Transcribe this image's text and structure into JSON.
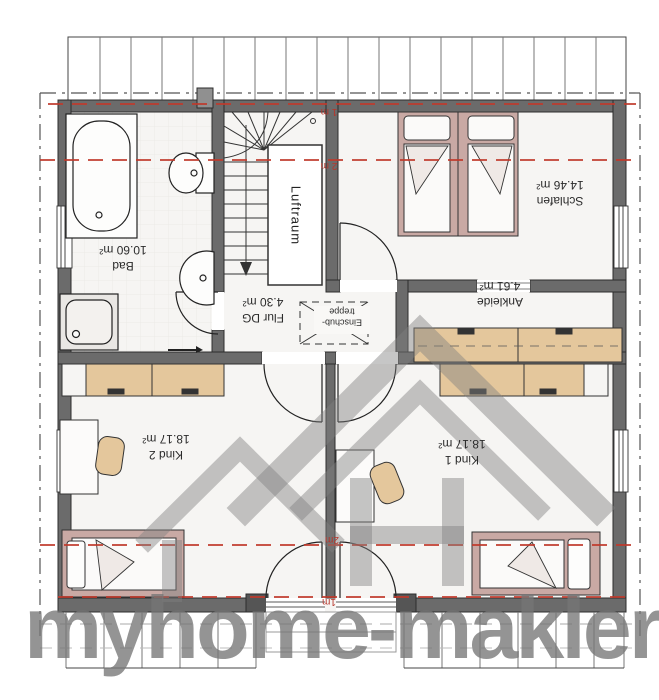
{
  "watermark": {
    "text": "myhome-makler"
  },
  "plan": {
    "rooms": {
      "bad": {
        "name": "Bad",
        "area": "10.60 m²"
      },
      "schlafen": {
        "name": "Schlafen",
        "area": "14.46 m²"
      },
      "flur": {
        "name": "Flur DG",
        "area": "4.30 m²"
      },
      "ankleide": {
        "name": "Ankleide",
        "area": "4.61 m²"
      },
      "kind1": {
        "name": "Kind 1",
        "area": "18.17 m²"
      },
      "kind2": {
        "name": "Kind 2",
        "area": "18.17 m²"
      }
    },
    "features": {
      "luftraum": "Luftraum",
      "einschub_line1": "Einschub-",
      "einschub_line2": "treppe"
    },
    "height_marks": {
      "top_1m": "1 m",
      "top_2m": "2 m",
      "bottom_2m": "2m",
      "bottom_1m": "1m"
    },
    "colors": {
      "wall": "#6b6b6b",
      "wall_dark": "#555555",
      "height_line": "#c0392b",
      "furniture_wood": "#e4c79c",
      "bed_frame": "#c9a9a4",
      "logo_gray": "rgba(128,128,128,0.45)"
    }
  }
}
